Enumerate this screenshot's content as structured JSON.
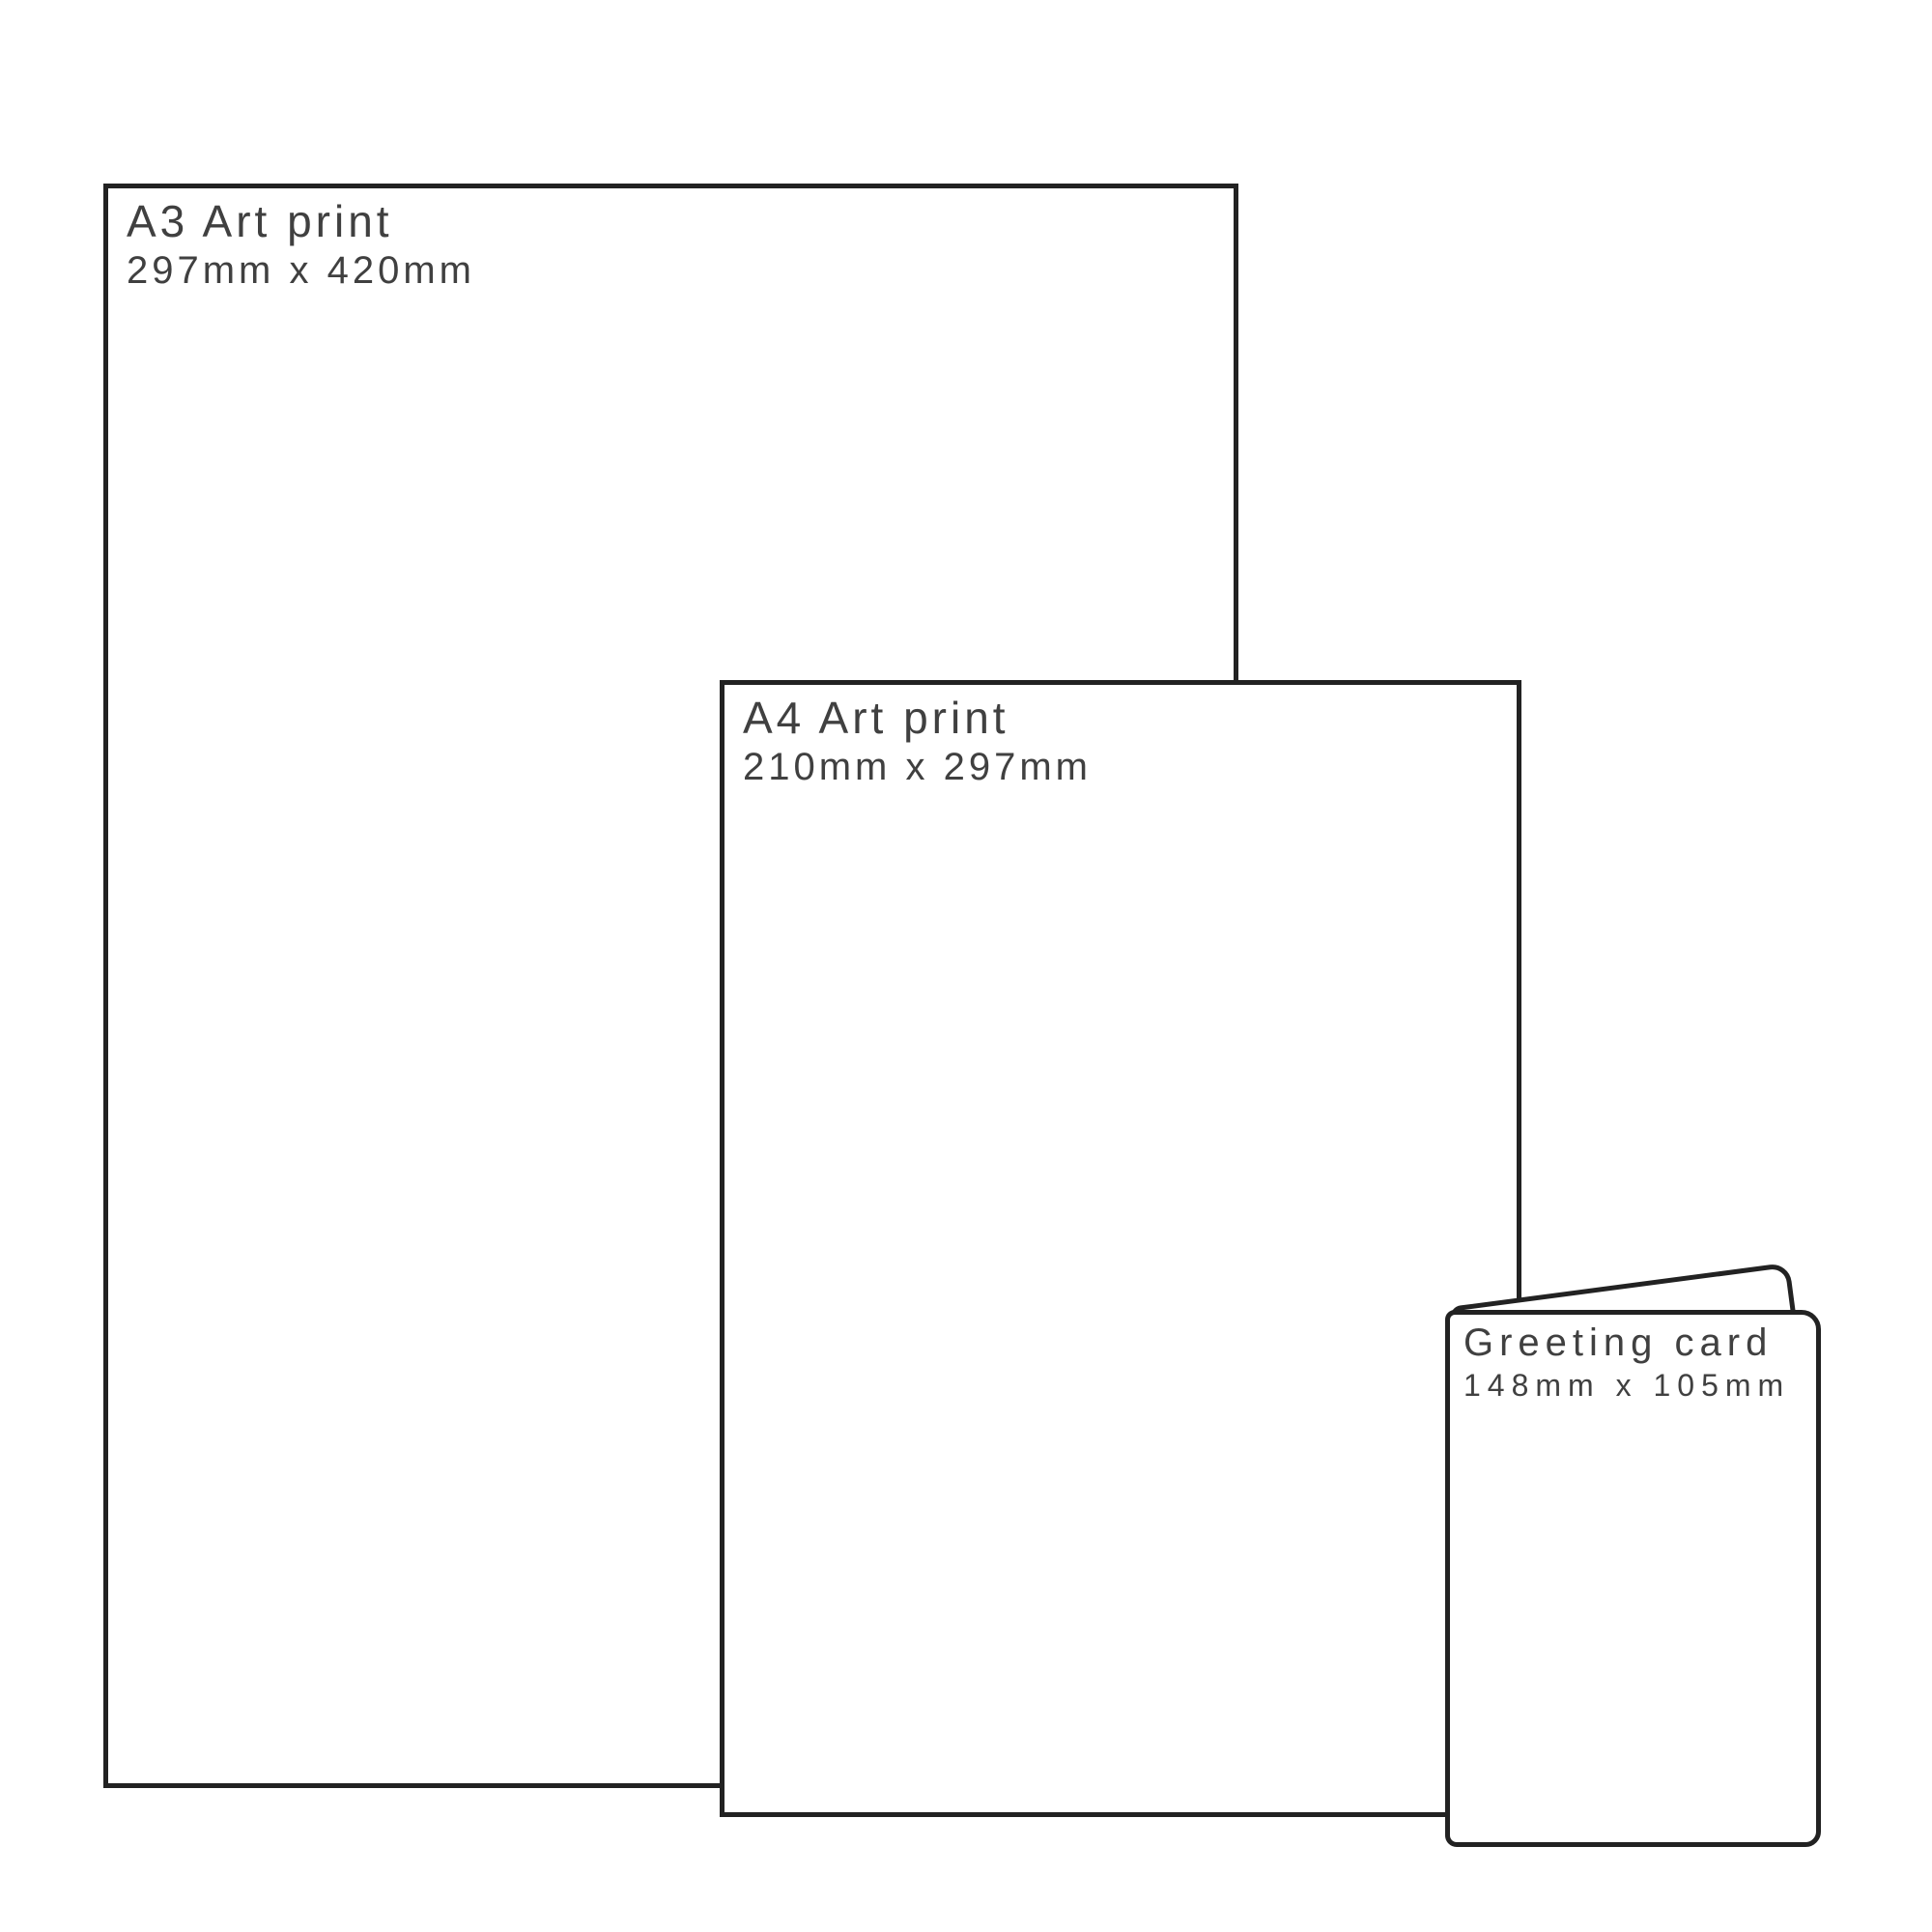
{
  "theme": {
    "line_color": "#222222",
    "text_color": "#404040",
    "bg_color": "#ffffff"
  },
  "diagram": {
    "kind": "print-size-comparison",
    "items": [
      {
        "id": "a3",
        "title": "A3 Art print",
        "dimensions": "297mm x 420mm"
      },
      {
        "id": "a4",
        "title": "A4 Art print",
        "dimensions": "210mm x 297mm"
      },
      {
        "id": "card",
        "title": "Greeting card",
        "dimensions": "148mm x 105mm"
      }
    ]
  }
}
